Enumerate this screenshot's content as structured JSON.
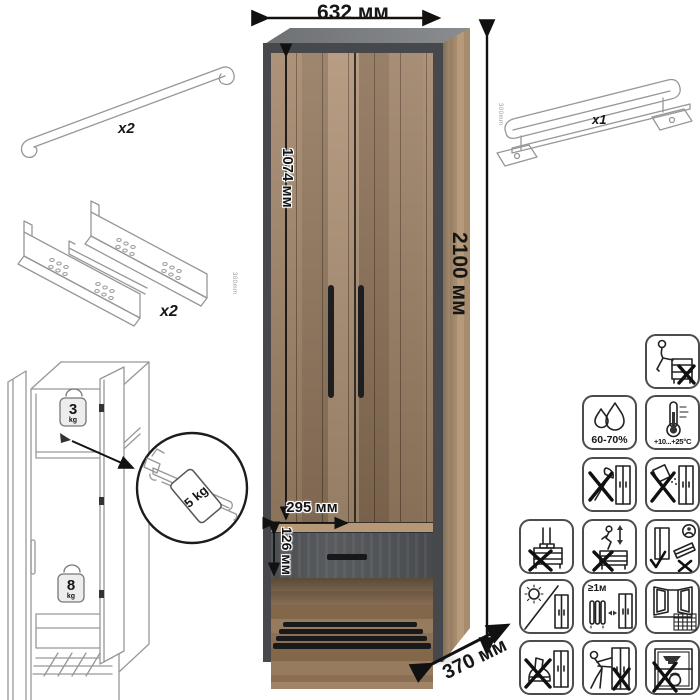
{
  "diagram": {
    "dims": {
      "width": "632 мм",
      "height": "2100 мм",
      "door_height": "1074 мм",
      "inner_width": "295 мм",
      "drawer_height": "126 мм",
      "depth": "370 мм"
    },
    "parts": {
      "handle_qty": "x2",
      "slides_qty": "x2",
      "slides_size": "300mm",
      "rail_qty": "x1",
      "rail_size": "300mm"
    },
    "load_limits": {
      "top_shelf_value": "3",
      "top_shelf_unit": "kg",
      "pullout_rail": "5 kg",
      "drawer_value": "8",
      "drawer_unit": "kg"
    },
    "care_icons": {
      "humidity": "60-70%",
      "temperature": "+10...+25°C",
      "heat_distance": "≥1м",
      "names": [
        "no-sitting-on-furniture",
        "humidity-60-70",
        "temperature-plus10-plus25",
        "no-sharp-tools",
        "no-spilling-abrasives",
        "no-standing-on-drawers",
        "no-climbing-on-drawers",
        "assemble-upright-only",
        "avoid-direct-sunlight",
        "keep-1m-from-heat-sources",
        "ventilate-open-window",
        "no-kicking-pushing-with-feet",
        "no-moving-when-assembled",
        "no-heavy-objects-inside"
      ]
    },
    "colors": {
      "wood": "#a5876a",
      "wood_light": "#b2977a",
      "graphite": "#46484b",
      "drawer_front": "#52555a",
      "handle_black": "#1b1c1e"
    }
  }
}
